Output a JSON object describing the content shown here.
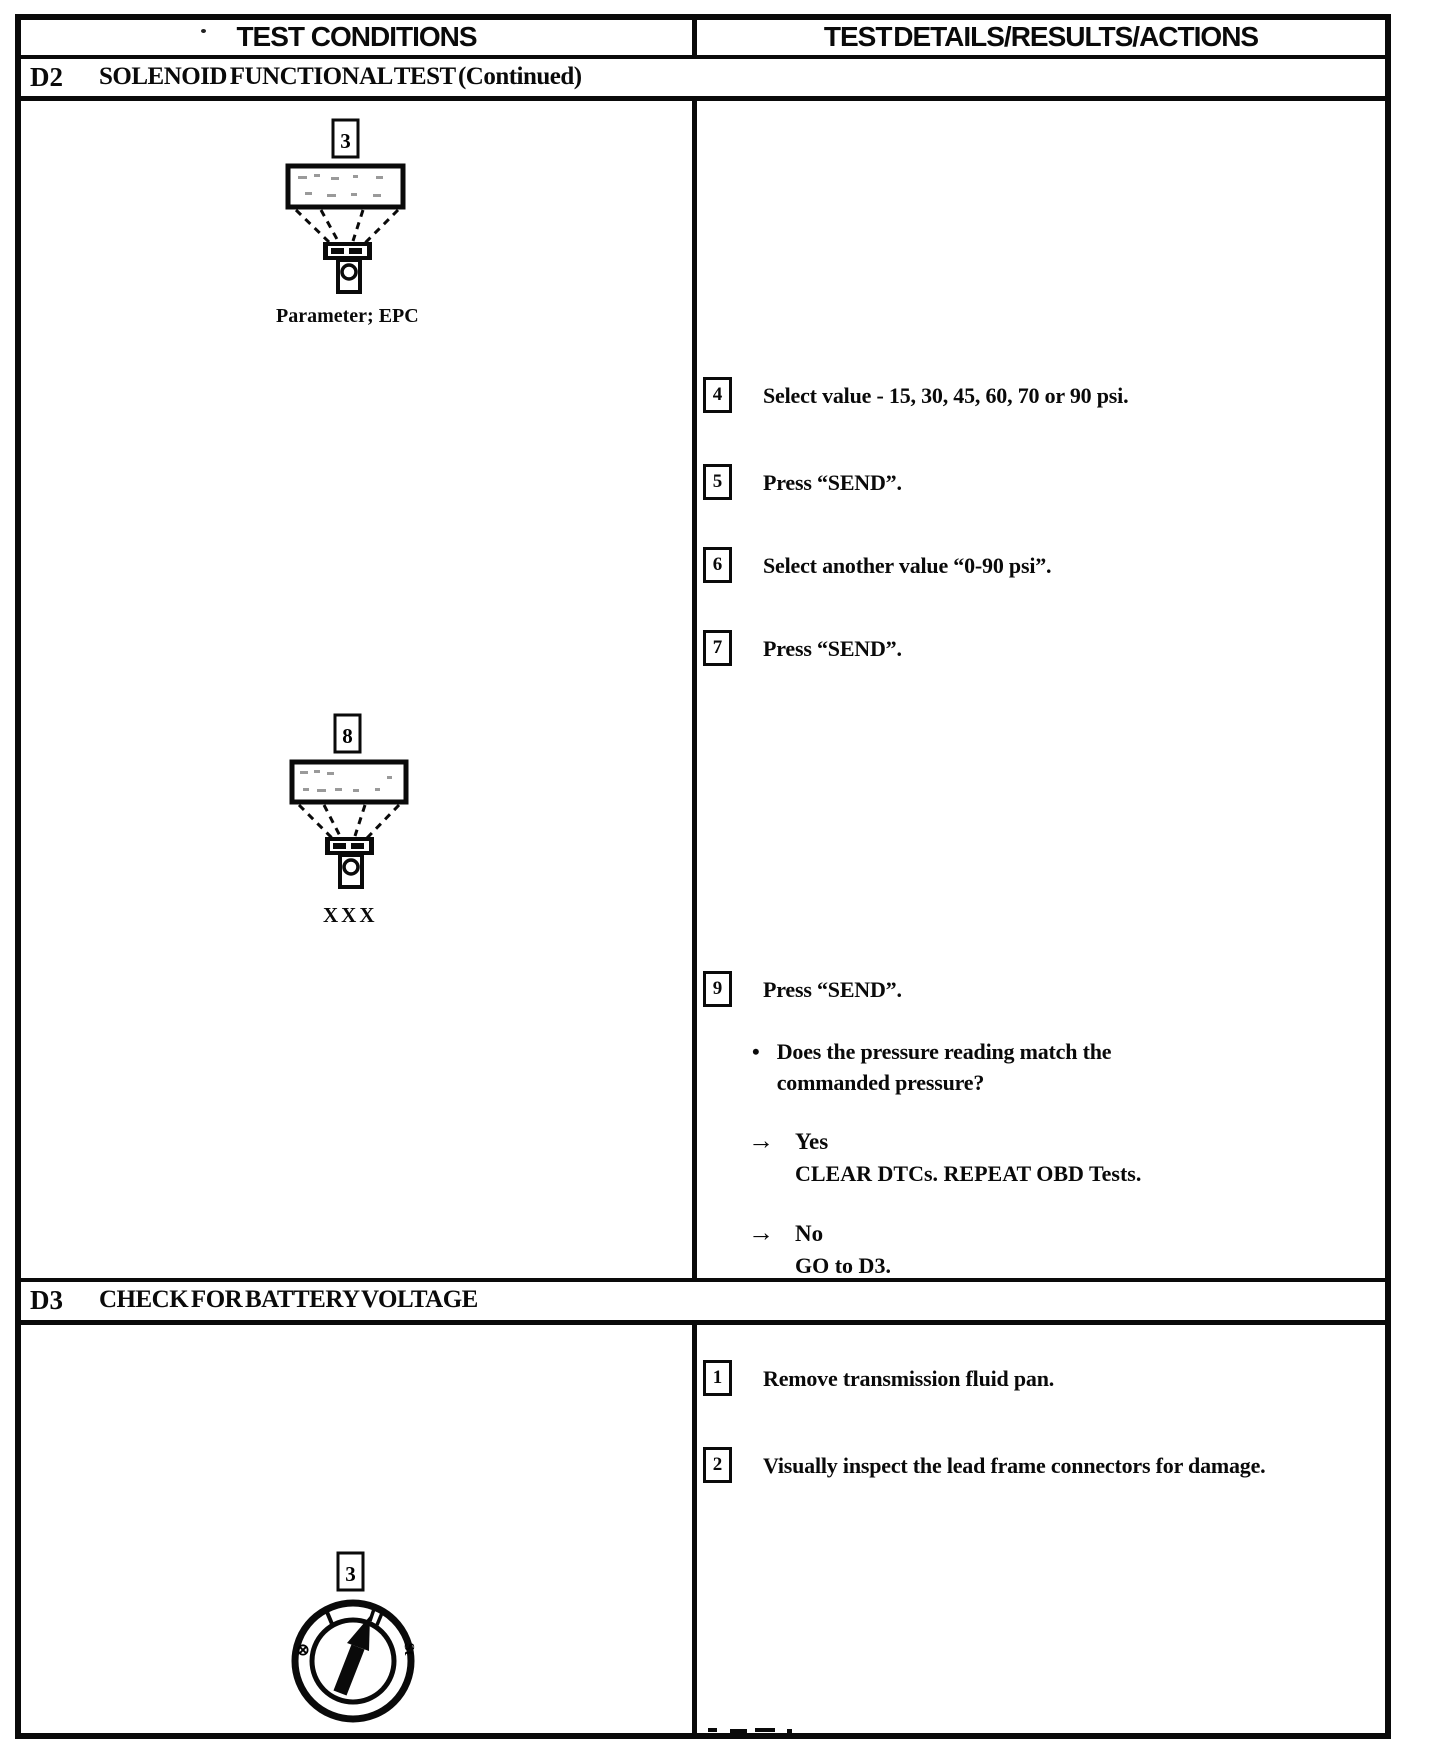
{
  "header": {
    "conditions_label": "TEST CONDITIONS",
    "details_label": "TEST DETAILS/RESULTS/ACTIONS"
  },
  "sections": [
    {
      "id": "D2",
      "title": "SOLENOID FUNCTIONAL TEST (Continued)",
      "figures": [
        {
          "step": "3",
          "caption": "Parameter; EPC"
        },
        {
          "step": "8",
          "caption": "XXX"
        }
      ],
      "steps": [
        {
          "num": "4",
          "text": "Select value - 15, 30, 45, 60, 70 or 90 psi."
        },
        {
          "num": "5",
          "text": "Press “SEND”."
        },
        {
          "num": "6",
          "text": "Select another value “0-90 psi”."
        },
        {
          "num": "7",
          "text": "Press “SEND”."
        },
        {
          "num": "9",
          "text": "Press “SEND”."
        }
      ],
      "question": "Does the pressure reading match the commanded pressure?",
      "results": [
        {
          "answer": "Yes",
          "action": "CLEAR DTCs. REPEAT OBD Tests."
        },
        {
          "answer": "No",
          "action": "GO to D3."
        }
      ]
    },
    {
      "id": "D3",
      "title": "CHECK FOR BATTERY VOLTAGE",
      "figures": [
        {
          "step": "3"
        }
      ],
      "steps": [
        {
          "num": "1",
          "text": "Remove transmission fluid pan."
        },
        {
          "num": "2",
          "text": "Visually inspect the lead frame connectors for damage."
        }
      ]
    }
  ],
  "ignition_dial": {
    "off": "⊗",
    "run_tick": "I",
    "start": "St"
  },
  "marks": {
    "bullet": "•",
    "arrow": "→"
  }
}
